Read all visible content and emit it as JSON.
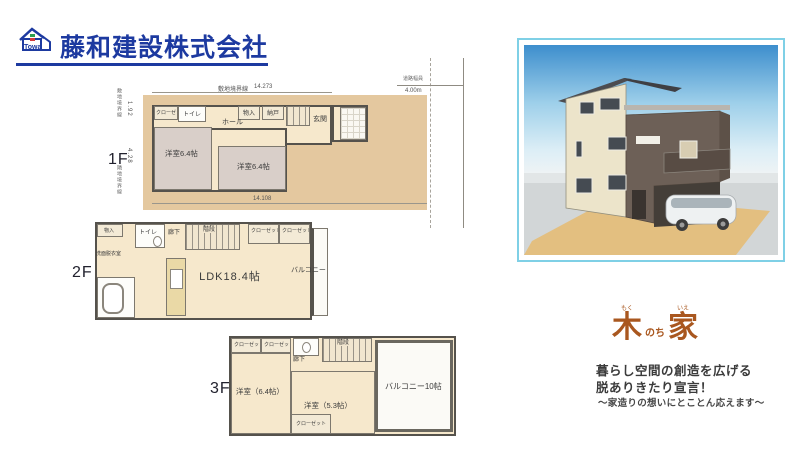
{
  "colors": {
    "brand_blue": "#1d3aa0",
    "logo_brown": "#a9571f",
    "render_border": "#7fd0e6",
    "site_tan": "#e4c89f",
    "floor_beige": "#f6e8cc"
  },
  "header": {
    "company": "藤和建設株式会社",
    "logo_text": "Towa"
  },
  "floor1": {
    "label": "1F",
    "rooms": {
      "closet": "クローゼット",
      "toilet": "トイレ",
      "storage1": "物入",
      "storage2": "納戸",
      "hall": "ホール",
      "entrance": "玄関",
      "room_left": "洋室6.4帖",
      "room_right": "洋室6.4帖"
    },
    "dims": {
      "top_label": "敷地境界線",
      "top_value": "14.273",
      "bottom_value": "14.108",
      "left_boundary_top": "敷地境界線",
      "left_value_top": "1.92",
      "left_value_mid": "4.28",
      "left_boundary_bottom": "隣地境界線",
      "road_label": "道路幅員",
      "road_value": "4.00m"
    }
  },
  "floor2": {
    "label": "2F",
    "rooms": {
      "storage": "物入",
      "toilet": "トイレ",
      "hallway": "廊下",
      "stairs": "階段",
      "closet1": "クローゼット",
      "closet2": "クローゼット",
      "washroom": "洗面脱衣室",
      "ldk": "LDK18.4帖",
      "balcony": "バルコニー"
    }
  },
  "floor3": {
    "label": "3F",
    "rooms": {
      "closet1": "クローゼット",
      "closet2": "クローゼット",
      "stairs": "階段",
      "hallway": "廊下",
      "room_left": "洋室（6.4帖）",
      "room_mid": "洋室（5.3帖）",
      "closet3": "クローゼット",
      "balcony": "バルコニー10帖"
    }
  },
  "branding": {
    "logo": {
      "kanji_left": "木",
      "furigana_left": "もく",
      "middle": "のち",
      "kanji_right": "家",
      "furigana_right": "いえ"
    },
    "slogan1": "暮らし空間の創造を広げる",
    "slogan2": "脱ありきたり宣言！",
    "slogan3": "～家造りの想いにとことん応えます～"
  }
}
